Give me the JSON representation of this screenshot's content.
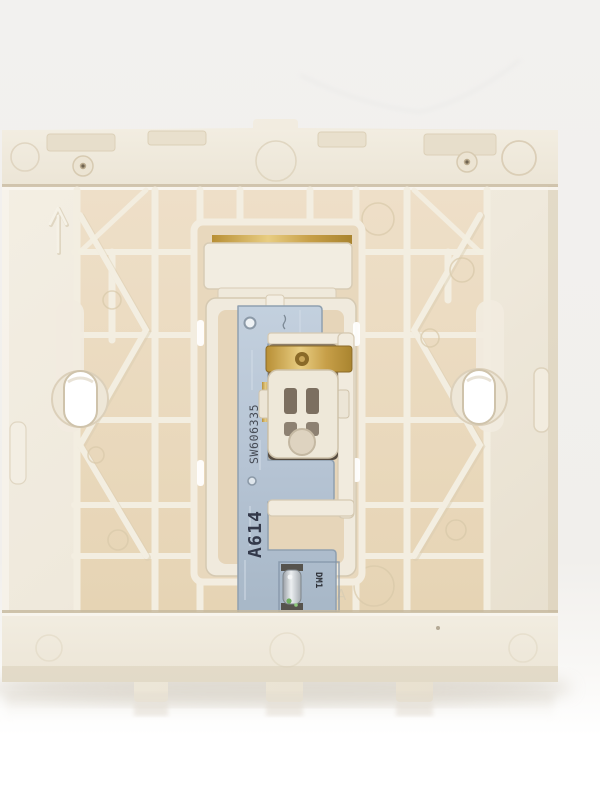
{
  "markings": {
    "pcb_serial": "SW606335",
    "pcb_model": "A614",
    "led_designator": "DM1",
    "mold_letter": "A"
  },
  "icons": {
    "orientation_arrow": "up-arrow"
  },
  "colors": {
    "backdrop_top": "#f2f1ef",
    "backdrop_bottom": "#ffffff",
    "plastic_cream": "#efe9dc",
    "plastic_highlight": "#f7f4ec",
    "plastic_shadow": "#d9cdb6",
    "pocket_tan": "#eadabf",
    "pcb_blue_grey": "#b6c4d4",
    "pcb_marking_ink": "#3d424e",
    "brass_contact": "#c79f48",
    "cavity_brown": "#6e6153",
    "led_metal": "#c8ccd0",
    "led_glint_green": "#6fae5f",
    "screw_hole_white": "#ffffff"
  }
}
